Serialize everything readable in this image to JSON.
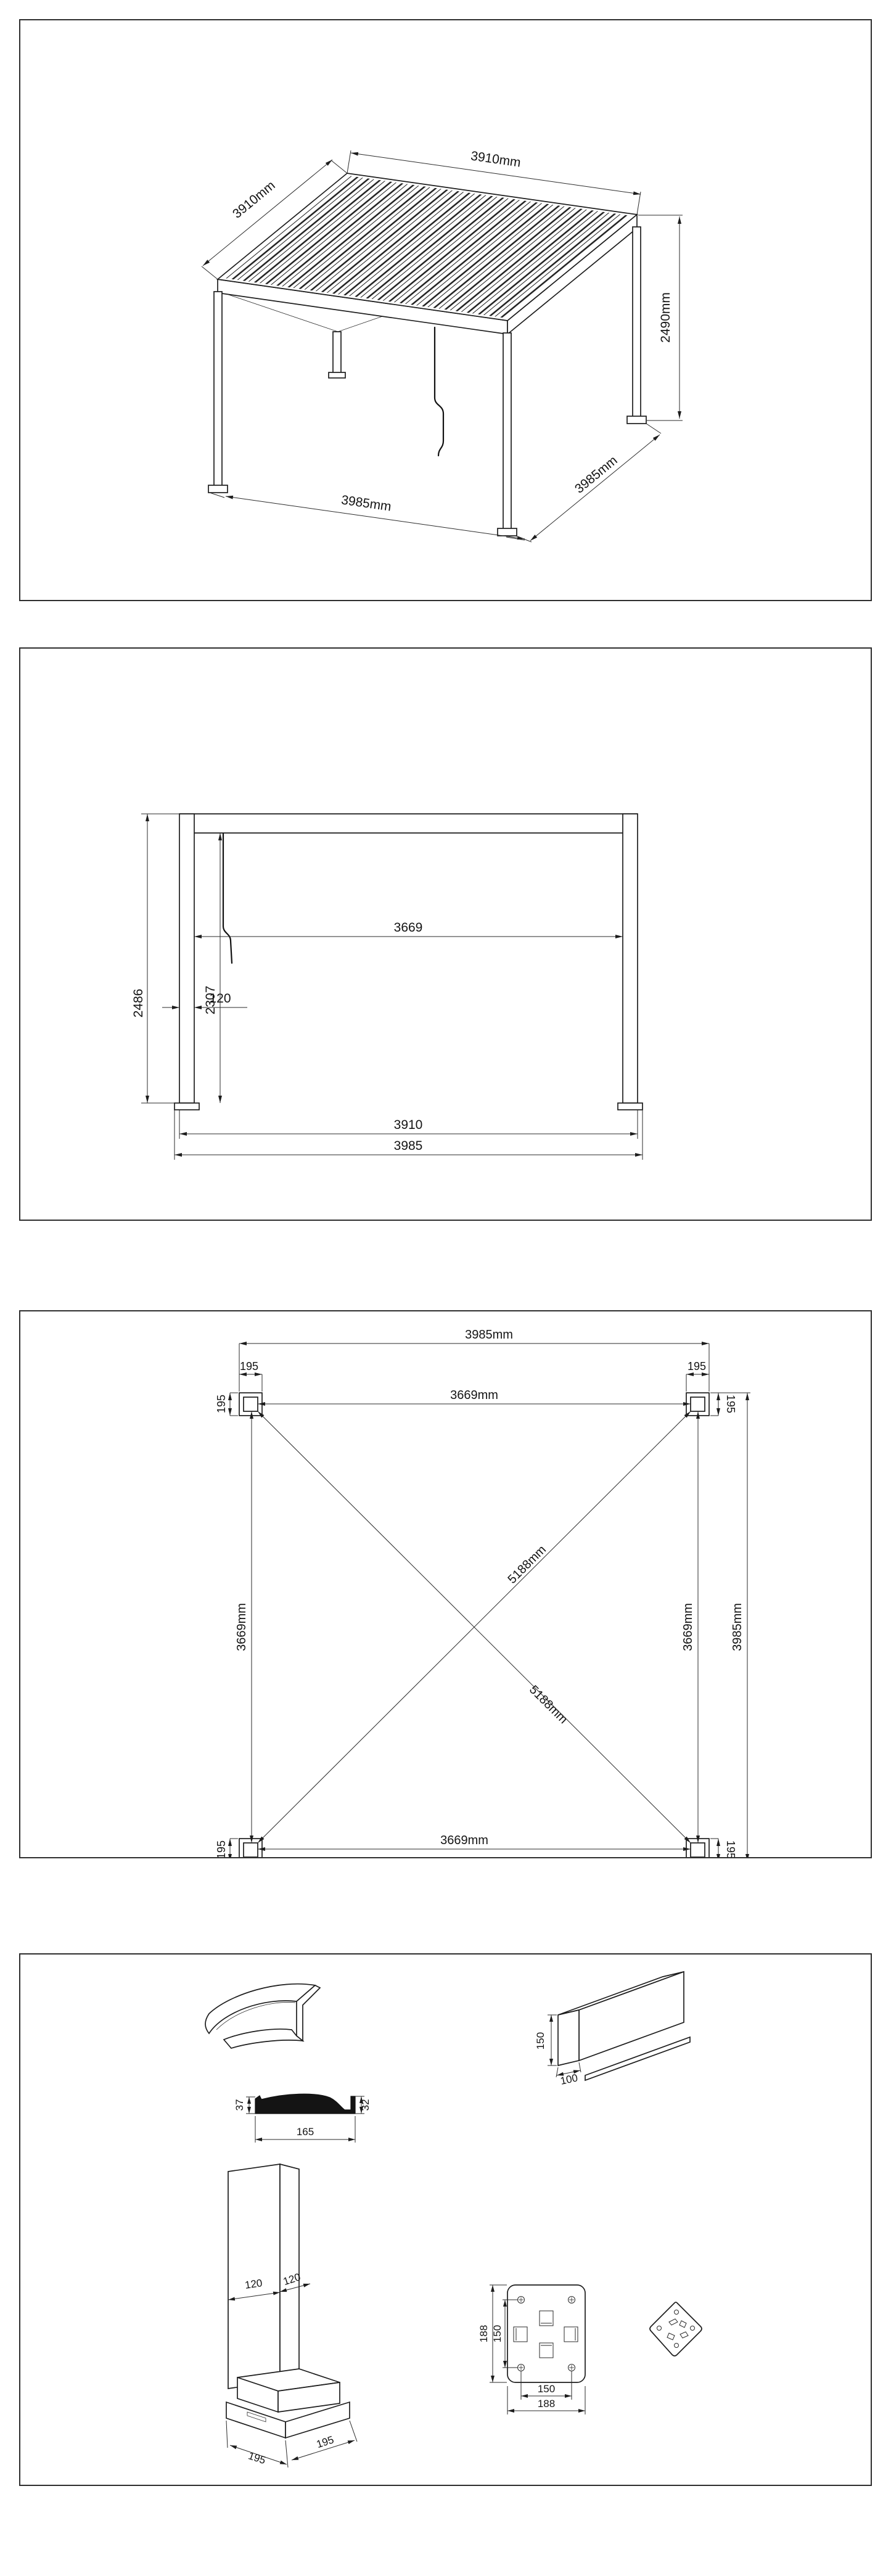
{
  "p1": {
    "dim_top": "3910mm",
    "dim_left": "3910mm",
    "dim_height": "2490mm",
    "dim_bottom_front": "3985mm",
    "dim_bottom_side": "3985mm"
  },
  "p2": {
    "dim_total_height": "2486",
    "dim_clear_height": "2307",
    "dim_post_width": "120",
    "dim_inner_span": "3669",
    "dim_post_span": "3910",
    "dim_base_span": "3985"
  },
  "p3": {
    "dim_outer_width": "3985mm",
    "dim_inner_width": "3669mm",
    "dim_inner_width_bottom": "3669mm",
    "dim_inner_height_left": "3669mm",
    "dim_inner_height_right": "3669mm",
    "dim_outer_height": "3985mm",
    "dim_diagonal_up": "5188mm",
    "dim_diagonal_down": "5188mm",
    "tl": {
      "w": "195",
      "h": "195"
    },
    "tr": {
      "w": "195",
      "h": "195"
    },
    "bl": {
      "w": "195",
      "h": "195"
    },
    "br": {
      "w": "195",
      "h": "195"
    }
  },
  "p4": {
    "louver": {
      "left_height": "37",
      "right_height": "32",
      "width": "165"
    },
    "beam": {
      "height": "150",
      "width": "100"
    },
    "post": {
      "width_front": "120",
      "width_side": "120",
      "base_front": "195",
      "base_side": "195"
    },
    "plate": {
      "outer_h": "188",
      "bolt_h": "150",
      "bolt_w": "150",
      "outer_w": "188"
    }
  }
}
